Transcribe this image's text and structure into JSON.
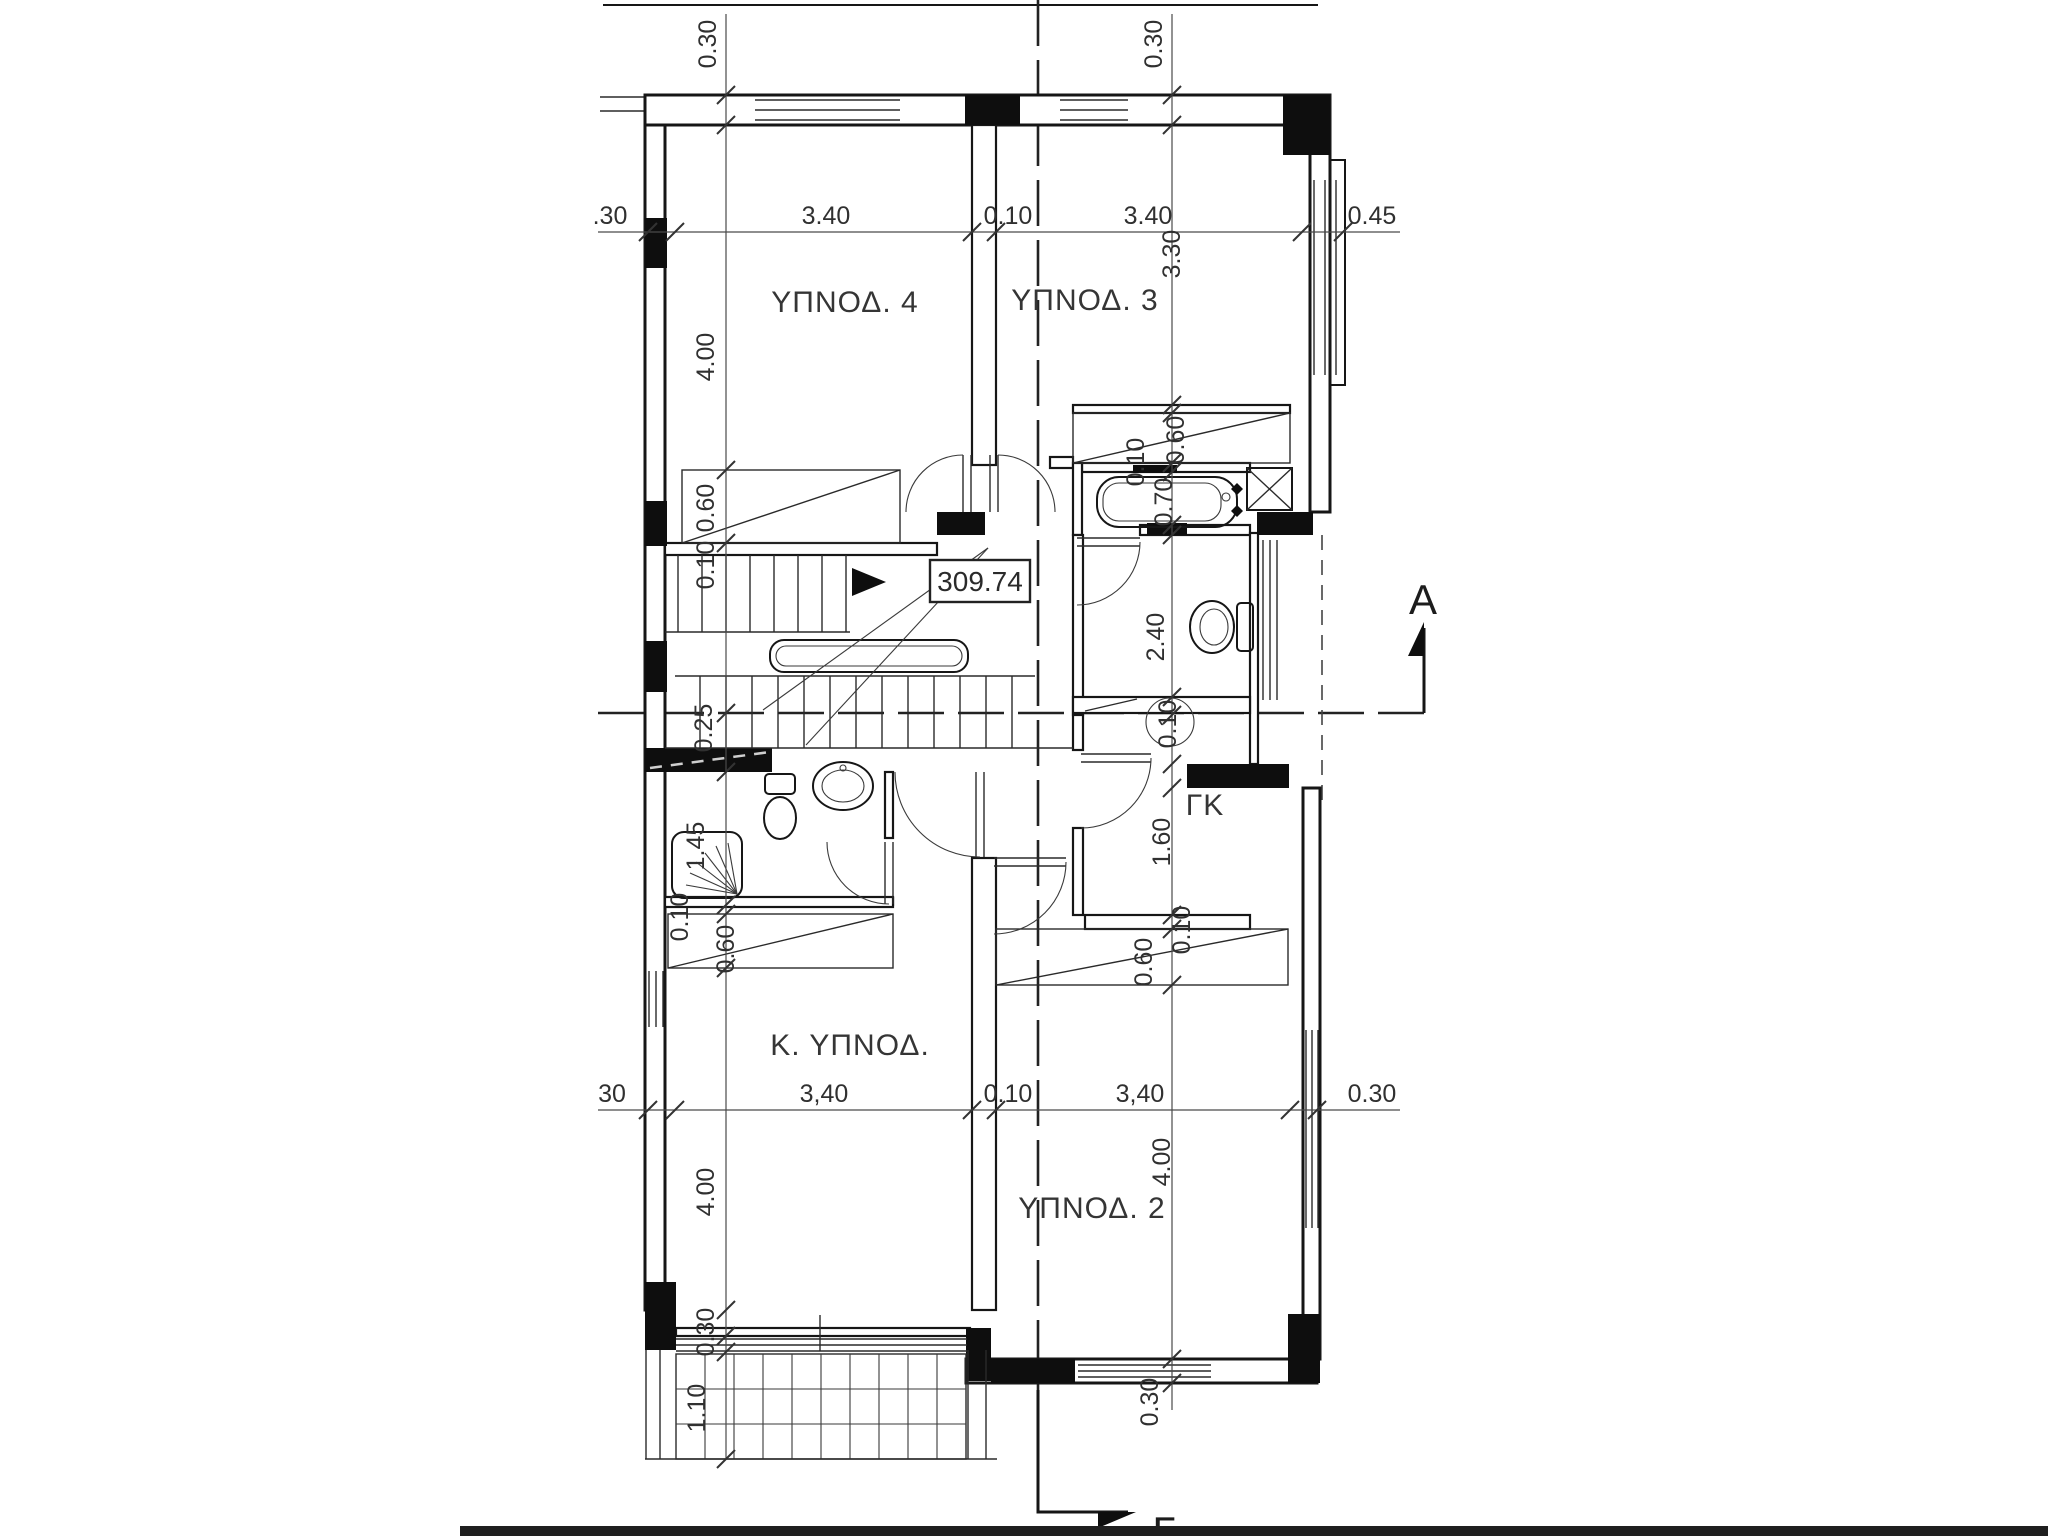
{
  "drawing": {
    "level_tag": "309.74",
    "section_marker_a": "A",
    "section_marker_gamma": "Γ",
    "rooms": [
      {
        "name": "room-label-bedroom4",
        "t": "ΥΠΝΟΔ. 4",
        "x": 845,
        "y": 312
      },
      {
        "name": "room-label-bedroom3",
        "t": "ΥΠΝΟΔ. 3",
        "x": 1085,
        "y": 310
      },
      {
        "name": "room-label-master-bedroom",
        "t": "Κ. ΥΠΝΟΔ.",
        "x": 850,
        "y": 1055
      },
      {
        "name": "room-label-bedroom2",
        "t": "ΥΠΝΟΔ. 2",
        "x": 1092,
        "y": 1218
      },
      {
        "name": "room-label-closet",
        "t": "ΓΚ",
        "x": 1205,
        "y": 815
      }
    ],
    "dim_labels": [
      {
        "t": "0.30",
        "x": 716,
        "y": 44,
        "r": -90
      },
      {
        "t": "0.30",
        "x": 1162,
        "y": 44,
        "r": -90
      },
      {
        "t": ".30",
        "x": 610,
        "y": 224,
        "r": 0
      },
      {
        "t": "3.40",
        "x": 826,
        "y": 224,
        "r": 0
      },
      {
        "t": "0.10",
        "x": 1008,
        "y": 224,
        "r": 0
      },
      {
        "t": "3.40",
        "x": 1148,
        "y": 224,
        "r": 0
      },
      {
        "t": "0.45",
        "x": 1372,
        "y": 224,
        "r": 0
      },
      {
        "t": "3.30",
        "x": 1180,
        "y": 254,
        "r": -90
      },
      {
        "t": "4.00",
        "x": 714,
        "y": 357,
        "r": -90
      },
      {
        "t": "0.60",
        "x": 1184,
        "y": 440,
        "r": -90
      },
      {
        "t": "0.10",
        "x": 1144,
        "y": 462,
        "r": -90
      },
      {
        "t": "0.70",
        "x": 1172,
        "y": 502,
        "r": -90
      },
      {
        "t": "0.60",
        "x": 714,
        "y": 508,
        "r": -90
      },
      {
        "t": "0.10",
        "x": 714,
        "y": 565,
        "r": -90
      },
      {
        "t": "2.40",
        "x": 1164,
        "y": 637,
        "r": -90
      },
      {
        "t": "0.25",
        "x": 712,
        "y": 728,
        "r": -90
      },
      {
        "t": "0.10",
        "x": 1176,
        "y": 724,
        "r": -90,
        "circle": true
      },
      {
        "t": "1.60",
        "x": 1170,
        "y": 842,
        "r": -90
      },
      {
        "t": "1.45",
        "x": 704,
        "y": 846,
        "r": -90
      },
      {
        "t": "0.10",
        "x": 688,
        "y": 917,
        "r": -90
      },
      {
        "t": "0.60",
        "x": 734,
        "y": 949,
        "r": -90
      },
      {
        "t": "0.10",
        "x": 1190,
        "y": 930,
        "r": -90
      },
      {
        "t": "0.60",
        "x": 1152,
        "y": 962,
        "r": -90
      },
      {
        "t": "30",
        "x": 612,
        "y": 1102,
        "r": 0
      },
      {
        "t": "3,40",
        "x": 824,
        "y": 1102,
        "r": 0
      },
      {
        "t": "0.10",
        "x": 1008,
        "y": 1102,
        "r": 0
      },
      {
        "t": "3,40",
        "x": 1140,
        "y": 1102,
        "r": 0
      },
      {
        "t": "0.30",
        "x": 1372,
        "y": 1102,
        "r": 0
      },
      {
        "t": "4.00",
        "x": 714,
        "y": 1192,
        "r": -90
      },
      {
        "t": "4.00",
        "x": 1170,
        "y": 1162,
        "r": -90
      },
      {
        "t": "0.30",
        "x": 714,
        "y": 1332,
        "r": -90
      },
      {
        "t": "0.30",
        "x": 1158,
        "y": 1402,
        "r": -90
      },
      {
        "t": "1.10",
        "x": 705,
        "y": 1408,
        "r": -90
      }
    ]
  }
}
